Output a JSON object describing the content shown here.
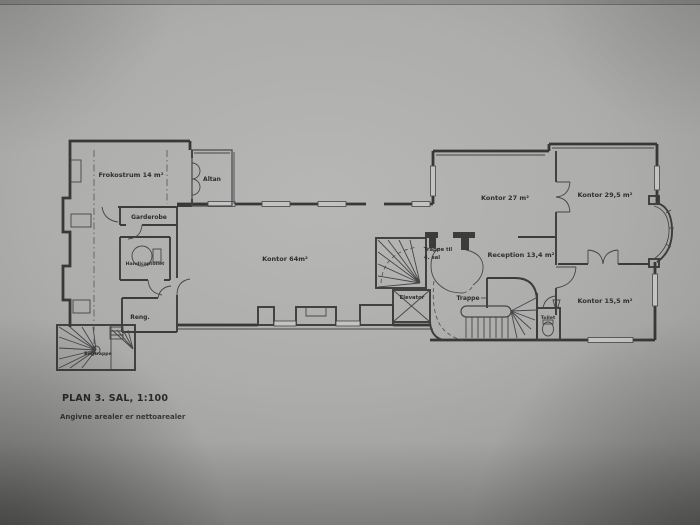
{
  "colors": {
    "paper": "#b0b0ae",
    "ink": "#3a3a3a"
  },
  "plan": {
    "title": "PLAN 3. SAL, 1:100",
    "note": "Angivne arealer er nettoarealer",
    "rooms": {
      "frokostrum": "Frokostrum 14 m²",
      "altan": "Altan",
      "garderobe": "Garderobe",
      "handicaptoilet": "Handicaptoilet",
      "reng": "Reng.",
      "bagtrappe": "Bagtrappe",
      "kontor64": "Kontor 64m²",
      "trappe_til_line1": "Trappe til",
      "trappe_til_line2": "4. sal",
      "elevator": "Elevator",
      "trappe": "Trappe",
      "kontor27": "Kontor 27 m²",
      "kontor295": "Kontor 29,5 m²",
      "reception": "Reception 13,4 m²",
      "kontor155": "Kontor 15,5 m²",
      "toilet": "Toilet"
    }
  }
}
